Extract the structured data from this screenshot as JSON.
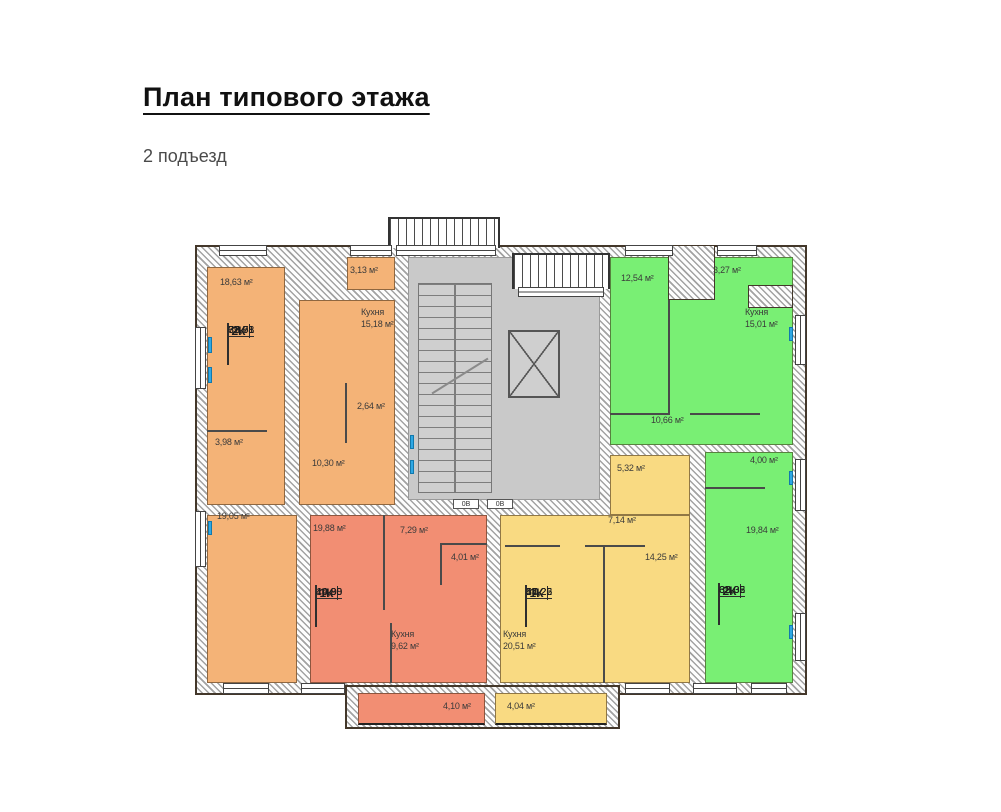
{
  "page": {
    "title": "План типового этажа",
    "subtitle": "2 подъезд"
  },
  "colors": {
    "apartment_orange": "#f4b377",
    "apartment_red": "#f28e73",
    "apartment_yellow": "#f9da82",
    "apartment_green": "#79ef74",
    "core_gray": "#c9c9c9",
    "window_blue": "#2fa8e4"
  },
  "apartments": [
    {
      "type_label": "2К",
      "color": "#f4b377",
      "areas": [
        "37,68",
        "69,78",
        "72,91"
      ],
      "rooms": [
        {
          "label": "18,63 м²"
        },
        {
          "label": "3,13 м²"
        },
        {
          "label": "Кухня\n15,18 м²"
        },
        {
          "label": "2,64 м²"
        },
        {
          "label": "3,98 м²"
        },
        {
          "label": "10,30 м²"
        },
        {
          "label": "19,05 м²"
        }
      ]
    },
    {
      "type_label": "1К",
      "color": "#f28e73",
      "areas": [
        "19,88",
        "40,80",
        "44,90"
      ],
      "rooms": [
        {
          "label": "19,88 м²"
        },
        {
          "label": "7,29 м²"
        },
        {
          "label": "4,01 м²"
        },
        {
          "label": "Кухня\n9,62 м²"
        },
        {
          "label": "4,10 м²"
        }
      ]
    },
    {
      "type_label": "1К",
      "color": "#f9da82",
      "areas": [
        "14,25",
        "47,22",
        "51,26"
      ],
      "rooms": [
        {
          "label": "5,32 м²"
        },
        {
          "label": "7,14 м²"
        },
        {
          "label": "14,25 м²"
        },
        {
          "label": "Кухня\n20,51 м²"
        },
        {
          "label": "4,04 м²"
        }
      ]
    },
    {
      "type_label": "2К",
      "color": "#79ef74",
      "areas": [
        "32,38",
        "62,05",
        "65,32"
      ],
      "rooms": [
        {
          "label": "12,54 м²"
        },
        {
          "label": "3,27 м²"
        },
        {
          "label": "Кухня\n15,01 м²"
        },
        {
          "label": "10,66 м²"
        },
        {
          "label": "4,00 м²"
        },
        {
          "label": "19,84 м²"
        }
      ]
    }
  ],
  "core": {
    "door_tags": [
      "0В",
      "0В"
    ]
  }
}
